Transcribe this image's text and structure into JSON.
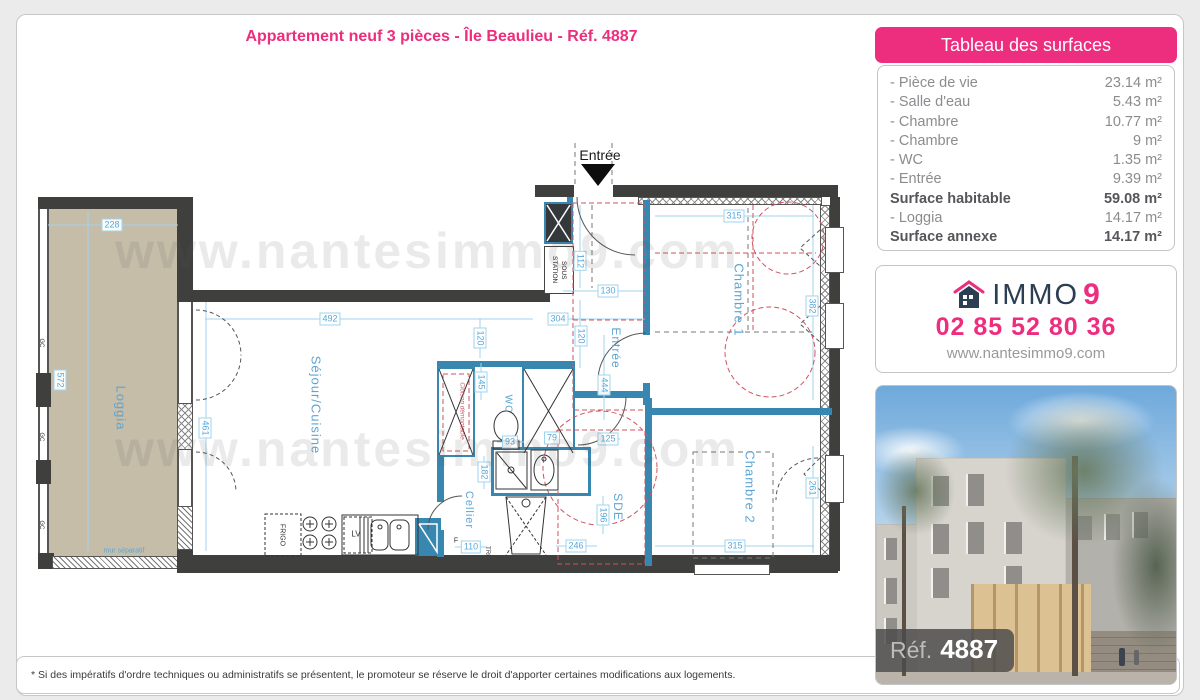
{
  "page": {
    "title": "Appartement neuf 3 pièces - Île Beaulieu - Réf. 4887",
    "watermark": "www.nantesimmo9.com",
    "disclaimer": "* Si des impératifs d'ordre techniques ou administratifs se présentent, le promoteur se réserve le droit d'apporter certaines modifications aux logements."
  },
  "surfaces_table": {
    "header": "Tableau des surfaces",
    "rows": [
      {
        "label": "- Pièce de vie",
        "value": "23.14 m²",
        "bold": false
      },
      {
        "label": "- Salle d'eau",
        "value": "5.43 m²",
        "bold": false
      },
      {
        "label": "- Chambre",
        "value": "10.77 m²",
        "bold": false
      },
      {
        "label": "- Chambre",
        "value": "9 m²",
        "bold": false
      },
      {
        "label": "- WC",
        "value": "1.35 m²",
        "bold": false
      },
      {
        "label": "- Entrée",
        "value": "9.39 m²",
        "bold": false
      },
      {
        "label": "Surface habitable",
        "value": "59.08 m²",
        "bold": true
      },
      {
        "label": "- Loggia",
        "value": "14.17 m²",
        "bold": false
      },
      {
        "label": "Surface annexe",
        "value": "14.17 m²",
        "bold": true
      }
    ]
  },
  "agency": {
    "brand_immo": "IMMO",
    "brand_9": "9",
    "phone": "02 85 52 80 36",
    "website": "www.nantesimmo9.com"
  },
  "photo": {
    "ref_label": "Réf.",
    "ref_number": "4887"
  },
  "floorplan": {
    "entrance_label": "Entrée",
    "sous_station": "SOUS STATION",
    "room_labels": [
      {
        "t": "Loggia",
        "x": 121,
        "y": 408,
        "s": 13
      },
      {
        "t": "Séjour/Cuisine",
        "x": 316,
        "y": 405,
        "s": 13
      },
      {
        "t": "WC",
        "x": 508,
        "y": 404,
        "s": 10
      },
      {
        "t": "Cellier",
        "x": 469,
        "y": 510,
        "s": 11
      },
      {
        "t": "SDE",
        "x": 618,
        "y": 507,
        "s": 12
      },
      {
        "t": "Entrée",
        "x": 616,
        "y": 348,
        "s": 12
      },
      {
        "t": "Chambre 1",
        "x": 739,
        "y": 300,
        "s": 13
      },
      {
        "t": "Chambre 2",
        "x": 750,
        "y": 487,
        "s": 13
      }
    ],
    "dimensions": [
      {
        "t": "228",
        "x": 112,
        "y": 225
      },
      {
        "t": "572",
        "x": 60,
        "y": 380,
        "v": 1
      },
      {
        "t": "461",
        "x": 205,
        "y": 428,
        "v": 1
      },
      {
        "t": "492",
        "x": 330,
        "y": 319
      },
      {
        "t": "145",
        "x": 481,
        "y": 382,
        "v": 1
      },
      {
        "t": "120",
        "x": 480,
        "y": 338,
        "v": 1
      },
      {
        "t": "112",
        "x": 580,
        "y": 261,
        "v": 1
      },
      {
        "t": "130",
        "x": 608,
        "y": 291
      },
      {
        "t": "304",
        "x": 558,
        "y": 319
      },
      {
        "t": "120",
        "x": 581,
        "y": 336,
        "v": 1
      },
      {
        "t": "444",
        "x": 604,
        "y": 385,
        "v": 1
      },
      {
        "t": "79",
        "x": 552,
        "y": 438
      },
      {
        "t": "93",
        "x": 510,
        "y": 442
      },
      {
        "t": "125",
        "x": 608,
        "y": 439
      },
      {
        "t": "182",
        "x": 484,
        "y": 472,
        "v": 1
      },
      {
        "t": "110",
        "x": 471,
        "y": 547
      },
      {
        "t": "196",
        "x": 603,
        "y": 515,
        "v": 1
      },
      {
        "t": "246",
        "x": 576,
        "y": 546
      },
      {
        "t": "315",
        "x": 734,
        "y": 216
      },
      {
        "t": "382",
        "x": 812,
        "y": 306,
        "v": 1
      },
      {
        "t": "315",
        "x": 735,
        "y": 546
      },
      {
        "t": "261",
        "x": 812,
        "y": 488,
        "v": 1
      }
    ],
    "notes": [
      {
        "t": "mur séparatif",
        "x": 124,
        "y": 551,
        "cls": "n-blue",
        "s": 7
      },
      {
        "t": "Cloison démontable",
        "x": 462,
        "y": 411,
        "cls": "n-red",
        "rot": 1,
        "s": 6.5
      },
      {
        "t": "FRIGO",
        "x": 282,
        "y": 535,
        "cls": "n-dark",
        "rot": 1,
        "s": 7
      },
      {
        "t": "LV",
        "x": 356,
        "y": 534,
        "cls": "n-dark",
        "s": 8
      },
      {
        "t": "TRI",
        "x": 487,
        "y": 551,
        "cls": "n-dark",
        "rot": 1,
        "s": 6
      },
      {
        "t": "F",
        "x": 456,
        "y": 541,
        "cls": "n-dark",
        "s": 7
      },
      {
        "t": "GC",
        "x": 41,
        "y": 343,
        "cls": "n-dark",
        "rot": 1,
        "s": 6
      },
      {
        "t": "GC",
        "x": 41,
        "y": 437,
        "cls": "n-dark",
        "rot": 1,
        "s": 6
      },
      {
        "t": "GC",
        "x": 41,
        "y": 525,
        "cls": "n-dark",
        "rot": 1,
        "s": 6
      }
    ]
  },
  "colors": {
    "accent_pink": "#ed2d7e",
    "brand_navy": "#2c3e53",
    "wall_dark": "#3f3f3d",
    "wall_blue": "#3787b0",
    "dim_blue": "#58a8d8",
    "red_dash": "#cf5360",
    "loggia_beige": "#c6bda9"
  }
}
